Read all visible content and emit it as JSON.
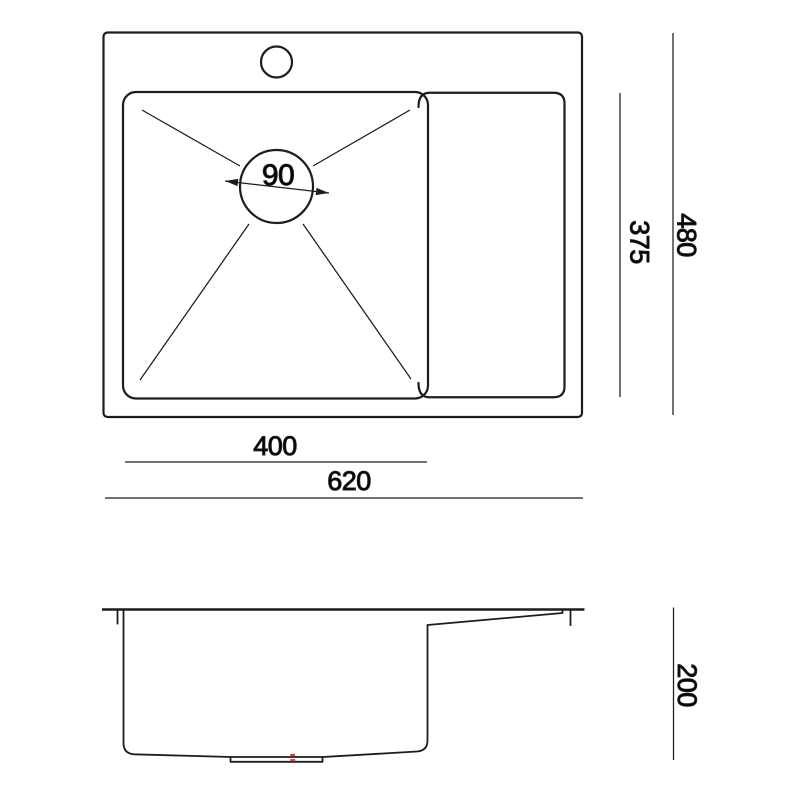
{
  "labels": {
    "drain_diameter": "90",
    "bowl_depth": "375",
    "overall_depth": "480",
    "bowl_width": "400",
    "overall_width": "620",
    "sink_height": "200"
  },
  "colors": {
    "line": "#1d1d1d",
    "accent_red": "#e8362b",
    "background": "#ffffff"
  }
}
